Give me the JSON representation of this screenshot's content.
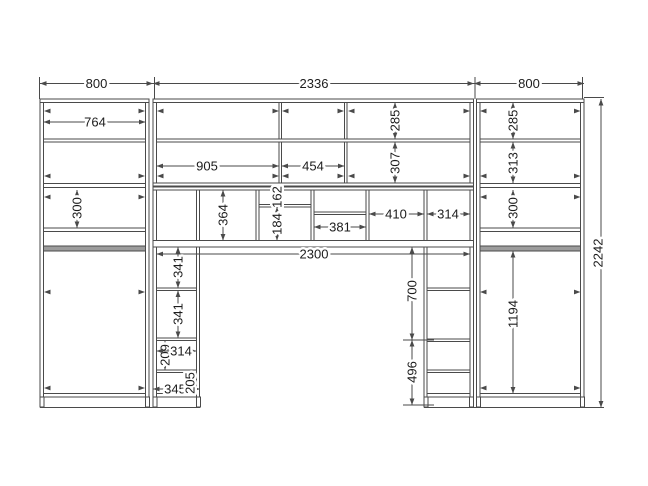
{
  "drawing": {
    "canvas": {
      "w": 648,
      "h": 486,
      "bg": "#ffffff",
      "line_color": "#4a4a4a",
      "text_color": "#1c1c1c",
      "rod_color": "#9c9c9c",
      "font_size": 13
    },
    "panels": [
      {
        "n": "left-cabinet-left-wall",
        "x": 40,
        "y": 99,
        "w": 3.5,
        "h": 298
      },
      {
        "n": "left-cabinet-right-wall",
        "x": 145.5,
        "y": 99,
        "w": 3.5,
        "h": 298
      },
      {
        "n": "middle-left-wall",
        "x": 153,
        "y": 99,
        "w": 3.5,
        "h": 298
      },
      {
        "n": "left-column-right-wall",
        "x": 196.5,
        "y": 188,
        "w": 3,
        "h": 209
      },
      {
        "n": "cubby-divider-1",
        "x": 256,
        "y": 188,
        "w": 3,
        "h": 53
      },
      {
        "n": "cubby-divider-2",
        "x": 311,
        "y": 188,
        "w": 3,
        "h": 53
      },
      {
        "n": "cubby-divider-3",
        "x": 366,
        "y": 188,
        "w": 3,
        "h": 53
      },
      {
        "n": "right-column-left-wall",
        "x": 424,
        "y": 188,
        "w": 3,
        "h": 209
      },
      {
        "n": "middle-right-wall",
        "x": 470,
        "y": 99,
        "w": 3.5,
        "h": 298
      },
      {
        "n": "right-cabinet-left-wall",
        "x": 476.5,
        "y": 99,
        "w": 3.5,
        "h": 298
      },
      {
        "n": "right-cabinet-right-wall",
        "x": 580.5,
        "y": 99,
        "w": 3.5,
        "h": 298
      },
      {
        "n": "upper-divider-a",
        "x": 279,
        "y": 102,
        "w": 2.5,
        "h": 82
      },
      {
        "n": "upper-divider-b",
        "x": 344.5,
        "y": 102,
        "w": 2.5,
        "h": 82
      },
      {
        "n": "left-cabinet-top",
        "x": 40,
        "y": 99,
        "w": 109,
        "h": 3.5
      },
      {
        "n": "middle-top",
        "x": 153,
        "y": 99,
        "w": 320.5,
        "h": 3.5
      },
      {
        "n": "right-cabinet-top",
        "x": 476.5,
        "y": 99,
        "w": 107.5,
        "h": 3.5
      },
      {
        "n": "left-shelf-a",
        "x": 43.5,
        "y": 139,
        "w": 102,
        "h": 3
      },
      {
        "n": "middle-shelf-a",
        "x": 156.5,
        "y": 139,
        "w": 313.5,
        "h": 3
      },
      {
        "n": "right-shelf-a",
        "x": 480,
        "y": 139,
        "w": 100.5,
        "h": 3
      },
      {
        "n": "left-shelf-b",
        "x": 43.5,
        "y": 183.5,
        "w": 102,
        "h": 4
      },
      {
        "n": "middle-bottom-panel",
        "x": 153,
        "y": 183,
        "w": 320.5,
        "h": 3
      },
      {
        "n": "cubby-top-panel",
        "x": 153,
        "y": 187,
        "w": 320.5,
        "h": 3
      },
      {
        "n": "right-shelf-b",
        "x": 480,
        "y": 183.5,
        "w": 100.5,
        "h": 4
      },
      {
        "n": "left-shelf-c",
        "x": 43.5,
        "y": 228,
        "w": 102,
        "h": 3.5
      },
      {
        "n": "right-shelf-c",
        "x": 480,
        "y": 228,
        "w": 100.5,
        "h": 3.5
      },
      {
        "n": "cubby-shelf-162-184",
        "x": 259,
        "y": 204.5,
        "w": 52,
        "h": 2.5
      },
      {
        "n": "cubby-shelf-381",
        "x": 314,
        "y": 212,
        "w": 52,
        "h": 2.5
      },
      {
        "n": "desk-panel",
        "x": 153,
        "y": 240.5,
        "w": 320.5,
        "h": 6.5
      },
      {
        "n": "left-column-shelf-1",
        "x": 156.5,
        "y": 288,
        "w": 40,
        "h": 2.5
      },
      {
        "n": "left-column-shelf-2",
        "x": 156.5,
        "y": 338,
        "w": 40,
        "h": 2.5
      },
      {
        "n": "left-column-shelf-3",
        "x": 156.5,
        "y": 370,
        "w": 40,
        "h": 2.5
      },
      {
        "n": "right-column-shelf-1",
        "x": 427,
        "y": 288,
        "w": 43,
        "h": 2.5
      },
      {
        "n": "right-column-shelf-2",
        "x": 427,
        "y": 339,
        "w": 43,
        "h": 2.5
      },
      {
        "n": "right-column-shelf-3",
        "x": 427,
        "y": 370,
        "w": 43,
        "h": 2.5
      },
      {
        "n": "left-cabinet-bottom",
        "x": 43.5,
        "y": 393.5,
        "w": 102,
        "h": 3.5
      },
      {
        "n": "left-column-bottom",
        "x": 156.5,
        "y": 393.5,
        "w": 40,
        "h": 3.5
      },
      {
        "n": "right-column-bottom",
        "x": 427,
        "y": 393.5,
        "w": 43,
        "h": 3.5
      },
      {
        "n": "right-cabinet-bottom",
        "x": 480,
        "y": 393.5,
        "w": 100.5,
        "h": 3.5
      }
    ],
    "rods": [
      {
        "n": "left-hanging-rod",
        "x": 43.5,
        "y": 246,
        "w": 102,
        "h": 5
      },
      {
        "n": "right-hanging-rod",
        "x": 480,
        "y": 246,
        "w": 100.5,
        "h": 5
      }
    ],
    "legs": [
      {
        "x": 40
      },
      {
        "x": 145.5
      },
      {
        "x": 153
      },
      {
        "x": 196.5
      },
      {
        "x": 424
      },
      {
        "x": 469.5
      },
      {
        "x": 476.5
      },
      {
        "x": 580.5
      }
    ],
    "leg_y": 397,
    "leg_h": 10,
    "leg_w": 4,
    "lines": [
      {
        "n": "base-line-left",
        "x1": 40,
        "y1": 407.5,
        "x2": 200,
        "y2": 407.5
      },
      {
        "n": "base-line-right",
        "x1": 424,
        "y1": 407.5,
        "x2": 604,
        "y2": 407.5
      },
      {
        "n": "ext-top-1",
        "x1": 39.5,
        "y1": 77,
        "x2": 39.5,
        "y2": 99
      },
      {
        "n": "ext-top-2",
        "x1": 154.5,
        "y1": 77,
        "x2": 154.5,
        "y2": 99
      },
      {
        "n": "ext-top-3",
        "x1": 475,
        "y1": 77,
        "x2": 475,
        "y2": 99
      },
      {
        "n": "ext-top-4",
        "x1": 582.5,
        "y1": 77,
        "x2": 582.5,
        "y2": 99
      },
      {
        "n": "ext-2242-top",
        "x1": 584,
        "y1": 97.5,
        "x2": 604,
        "y2": 97.5
      },
      {
        "n": "ext-700-top",
        "x1": 403,
        "y1": 247,
        "x2": 426,
        "y2": 247
      },
      {
        "n": "ext-700-496",
        "x1": 403,
        "y1": 340,
        "x2": 434,
        "y2": 340
      },
      {
        "n": "ext-496-bottom",
        "x1": 403,
        "y1": 405,
        "x2": 434,
        "y2": 405
      }
    ],
    "dims": [
      {
        "label": "800",
        "dir": "h",
        "a": 40,
        "b": 153,
        "pos": 83.5,
        "t": 96.5
      },
      {
        "label": "2336",
        "dir": "h",
        "a": 153,
        "b": 474,
        "pos": 83.5,
        "t": 314
      },
      {
        "label": "800",
        "dir": "h",
        "a": 474,
        "b": 584,
        "pos": 83.5,
        "t": 529
      },
      {
        "label": "764",
        "dir": "h",
        "a": 43.5,
        "b": 145.5,
        "pos": 122,
        "t": 95
      },
      {
        "label": "905",
        "dir": "h",
        "a": 156.5,
        "b": 279,
        "pos": 166,
        "t": 207
      },
      {
        "label": "454",
        "dir": "h",
        "a": 281.5,
        "b": 344.5,
        "pos": 166,
        "t": 313
      },
      {
        "label": "285",
        "dir": "v",
        "a": 102.5,
        "b": 139,
        "pos": 395,
        "t": 120.5
      },
      {
        "label": "307",
        "dir": "v",
        "a": 142,
        "b": 183,
        "pos": 395,
        "t": 163
      },
      {
        "label": "285",
        "dir": "v",
        "a": 102.5,
        "b": 139,
        "pos": 513,
        "t": 120.5
      },
      {
        "label": "313",
        "dir": "v",
        "a": 142,
        "b": 183,
        "pos": 513,
        "t": 163
      },
      {
        "label": "300",
        "dir": "v",
        "a": 190,
        "b": 228,
        "pos": 77,
        "t": 208
      },
      {
        "label": "300",
        "dir": "v",
        "a": 190,
        "b": 228,
        "pos": 513,
        "t": 208
      },
      {
        "label": "364",
        "dir": "v",
        "a": 190,
        "b": 240.5,
        "pos": 223,
        "t": 215
      },
      {
        "label": "162",
        "dir": "v",
        "a": 190,
        "b": 204.5,
        "pos": 277,
        "t": 197
      },
      {
        "label": "184",
        "dir": "v",
        "a": 207,
        "b": 240.5,
        "pos": 277,
        "t": 224
      },
      {
        "label": "381",
        "dir": "h",
        "a": 314,
        "b": 366,
        "pos": 227,
        "t": 340
      },
      {
        "label": "410",
        "dir": "h",
        "a": 369,
        "b": 424,
        "pos": 214,
        "t": 396
      },
      {
        "label": "314",
        "dir": "h",
        "a": 427,
        "b": 470,
        "pos": 214,
        "t": 448
      },
      {
        "label": "2300",
        "dir": "h",
        "a": 156.5,
        "b": 470,
        "pos": 254,
        "t": 314
      },
      {
        "label": "341",
        "dir": "v",
        "a": 247,
        "b": 288,
        "pos": 178,
        "t": 267
      },
      {
        "label": "341",
        "dir": "v",
        "a": 290.5,
        "b": 338,
        "pos": 178,
        "t": 314
      },
      {
        "label": "209",
        "dir": "v",
        "a": 340.5,
        "b": 370,
        "pos": 165,
        "t": 355
      },
      {
        "label": "314",
        "dir": "h",
        "a": 156.5,
        "b": 196.5,
        "pos": 351,
        "t": 181
      },
      {
        "label": "345",
        "dir": "h",
        "a": 153,
        "b": 200,
        "pos": 389,
        "t": 175
      },
      {
        "label": "205",
        "dir": "v",
        "a": 372.5,
        "b": 393.5,
        "pos": 190,
        "t": 383
      },
      {
        "label": "700",
        "dir": "v",
        "a": 247,
        "b": 340,
        "pos": 412,
        "t": 291
      },
      {
        "label": "496",
        "dir": "v",
        "a": 340,
        "b": 405,
        "pos": 412,
        "t": 372
      },
      {
        "label": "1194",
        "dir": "v",
        "a": 251,
        "b": 393.5,
        "pos": 513,
        "t": 314
      },
      {
        "label": "2242",
        "dir": "v",
        "a": 99,
        "b": 407.5,
        "pos": 601,
        "t": 253,
        "toff": -3
      }
    ],
    "wall_arrows": [
      {
        "x": 44,
        "y": 111,
        "dir": "left"
      },
      {
        "x": 145,
        "y": 111,
        "dir": "right"
      },
      {
        "x": 157,
        "y": 111,
        "dir": "left"
      },
      {
        "x": 279,
        "y": 111,
        "dir": "right"
      },
      {
        "x": 282,
        "y": 111,
        "dir": "left"
      },
      {
        "x": 344,
        "y": 111,
        "dir": "right"
      },
      {
        "x": 348,
        "y": 111,
        "dir": "left"
      },
      {
        "x": 470,
        "y": 111,
        "dir": "right"
      },
      {
        "x": 480,
        "y": 111,
        "dir": "left"
      },
      {
        "x": 580.5,
        "y": 111,
        "dir": "right"
      },
      {
        "x": 44,
        "y": 176,
        "dir": "left"
      },
      {
        "x": 145,
        "y": 176,
        "dir": "right"
      },
      {
        "x": 157,
        "y": 176,
        "dir": "left"
      },
      {
        "x": 279,
        "y": 176,
        "dir": "right"
      },
      {
        "x": 282,
        "y": 176,
        "dir": "left"
      },
      {
        "x": 344,
        "y": 176,
        "dir": "right"
      },
      {
        "x": 348,
        "y": 176,
        "dir": "left"
      },
      {
        "x": 470,
        "y": 176,
        "dir": "right"
      },
      {
        "x": 480,
        "y": 176,
        "dir": "left"
      },
      {
        "x": 580.5,
        "y": 176,
        "dir": "right"
      },
      {
        "x": 44,
        "y": 197,
        "dir": "left"
      },
      {
        "x": 145,
        "y": 197,
        "dir": "right"
      },
      {
        "x": 480,
        "y": 197,
        "dir": "left"
      },
      {
        "x": 580.5,
        "y": 197,
        "dir": "right"
      },
      {
        "x": 44,
        "y": 292,
        "dir": "left"
      },
      {
        "x": 145,
        "y": 292,
        "dir": "right"
      },
      {
        "x": 480,
        "y": 292,
        "dir": "left"
      },
      {
        "x": 580.5,
        "y": 292,
        "dir": "right"
      },
      {
        "x": 44,
        "y": 388,
        "dir": "left"
      },
      {
        "x": 145,
        "y": 388,
        "dir": "right"
      },
      {
        "x": 480,
        "y": 388,
        "dir": "left"
      },
      {
        "x": 580.5,
        "y": 388,
        "dir": "right"
      }
    ]
  }
}
